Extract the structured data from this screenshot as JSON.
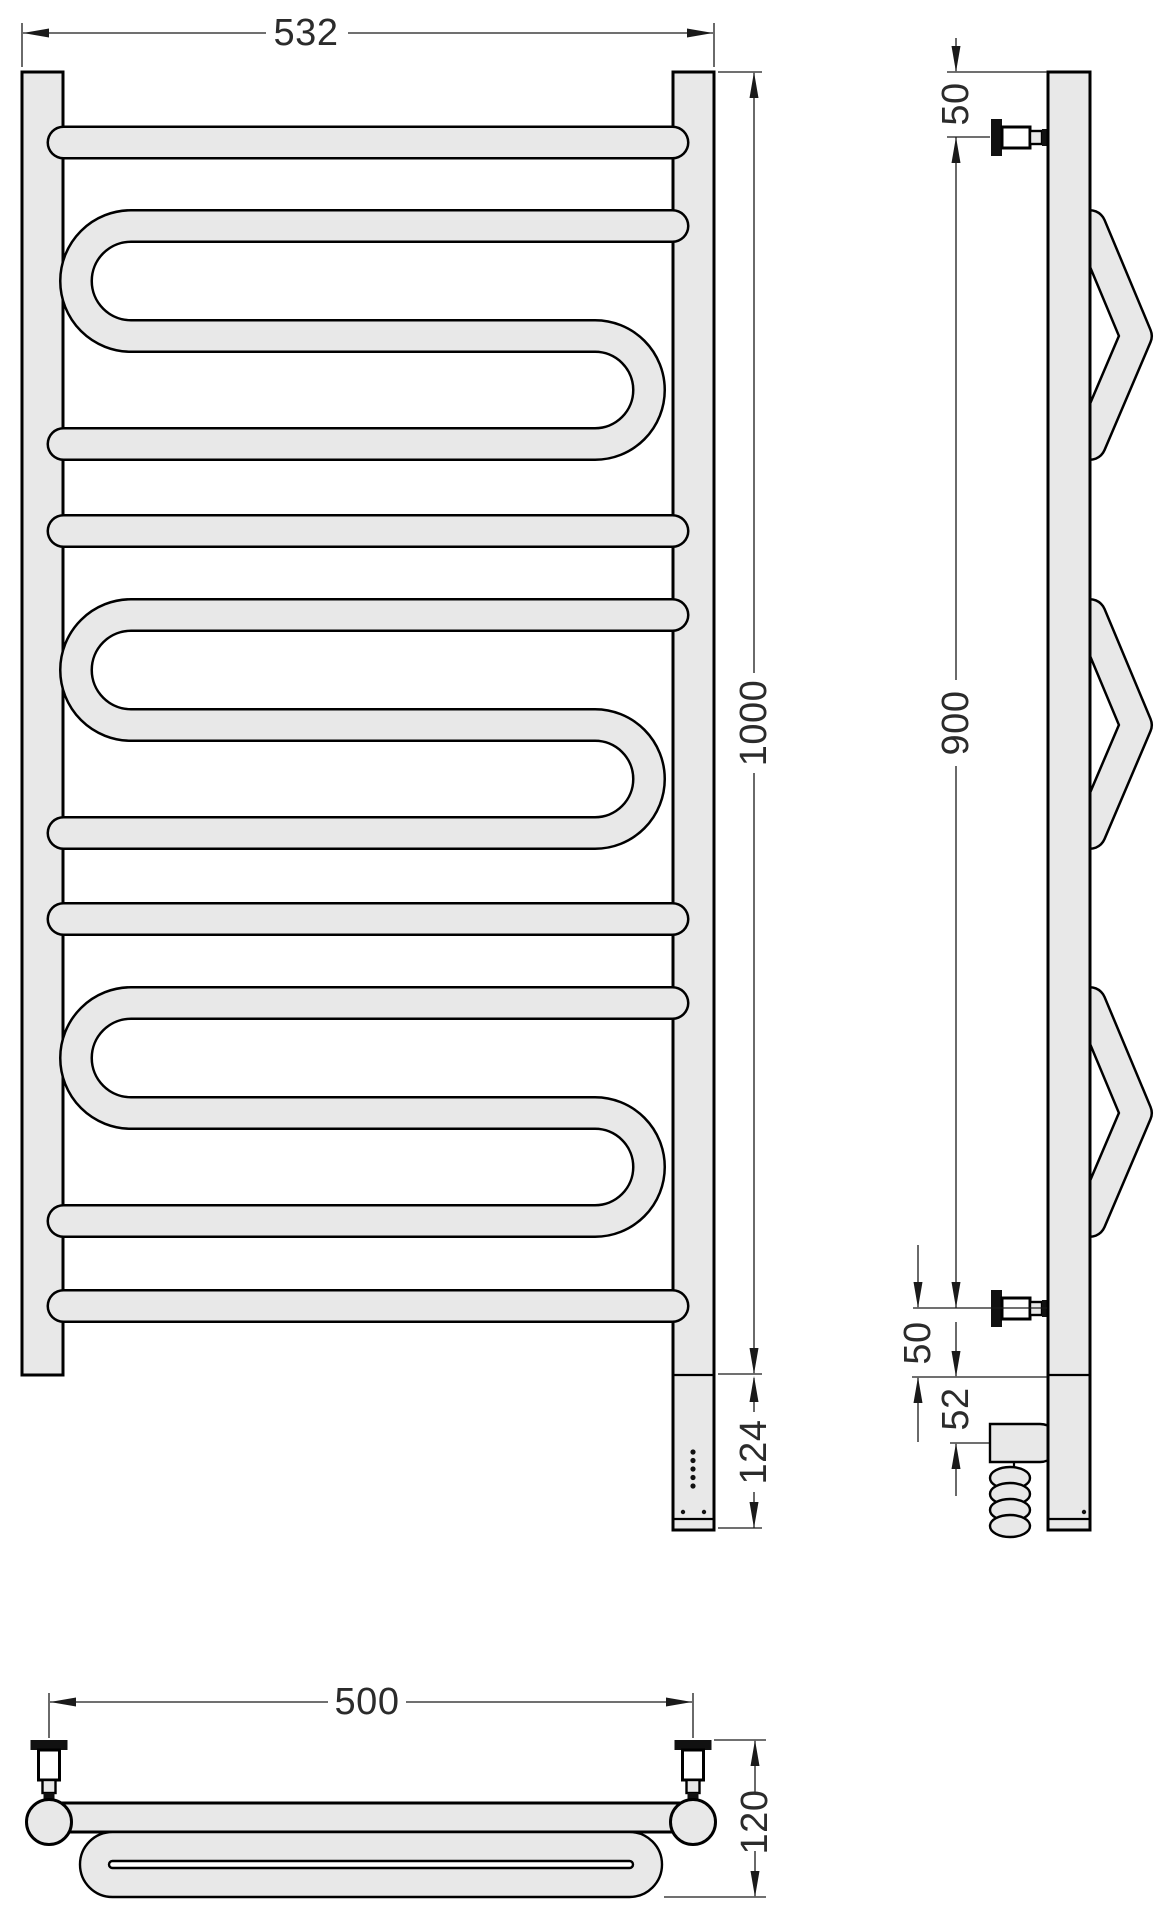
{
  "drawing": {
    "kind": "technical-drawing",
    "subject": "heated towel rail with serpentine coils, three orthographic views"
  },
  "colors": {
    "background": "#ffffff",
    "tube_fill": "#e8e8e8",
    "outline": "#000000",
    "dimension_text": "#2b2b2b"
  },
  "views": {
    "front": {
      "label": "front view",
      "dims": {
        "overall_width": "532",
        "overall_height": "1000",
        "element_section_height": "124"
      }
    },
    "side": {
      "label": "side view",
      "dims": {
        "top_to_mount": "50",
        "mount_spacing": "900",
        "mount_to_bottom": "50",
        "bottom_to_element": "52"
      }
    },
    "bottom": {
      "label": "bottom plan view",
      "dims": {
        "mounting_centers": "500",
        "depth": "120"
      }
    }
  }
}
